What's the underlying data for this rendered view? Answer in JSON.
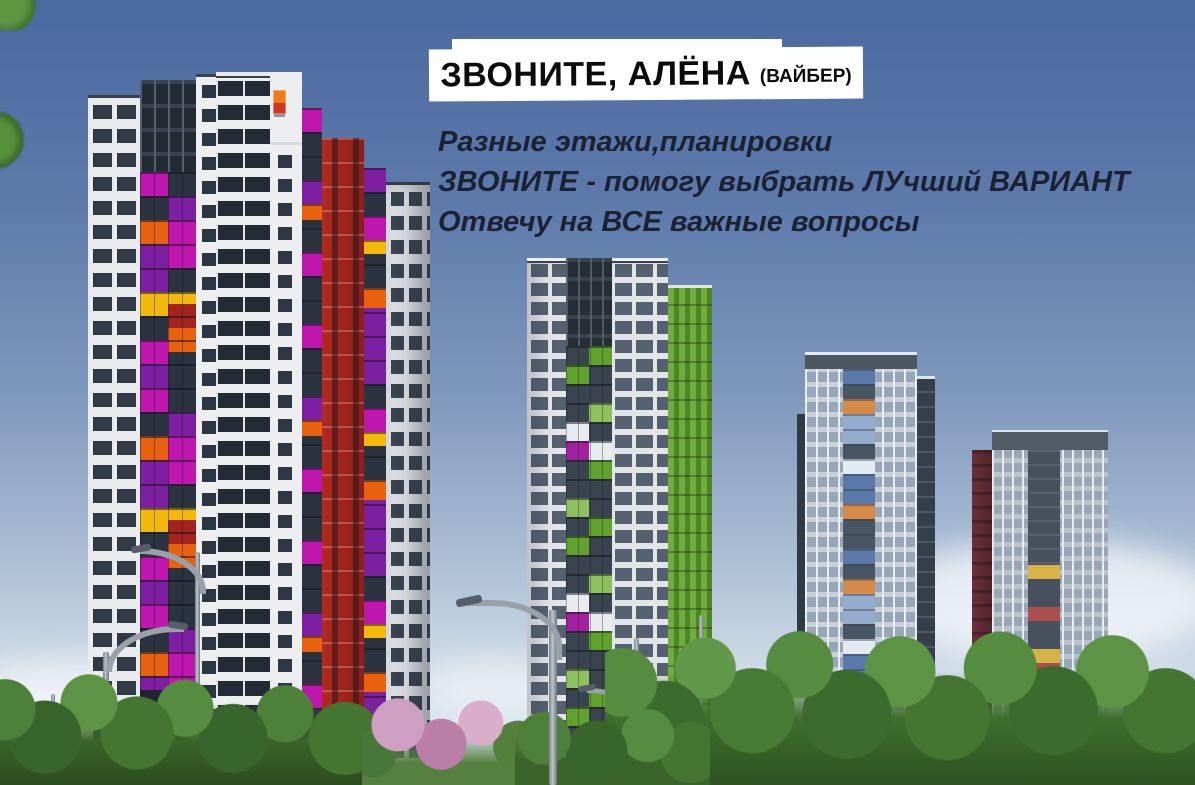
{
  "ad": {
    "headline": "ЗВОНИТЕ, АЛЁНА",
    "headline_note": "(ВАЙБЕР)",
    "lines": [
      "Разные этажи,планировки",
      "ЗВОНИТЕ - помогу выбрать ЛУчший ВАРИАНТ",
      "Отвечу на ВСЕ важные вопросы"
    ],
    "headline_text_color": "#0b0b0b",
    "headline_bg_color": "#ffffff",
    "body_text_color": "#1a2233"
  },
  "scene": {
    "type": "residential-complex-render",
    "sky": {
      "top_color": "#4a699f",
      "horizon_color": "#e4ecf2"
    },
    "towers": [
      {
        "id": "tower-1-left-foreground",
        "facade_color": "#e9ebed",
        "accent_colors": [
          "#bf17ae",
          "#7c1fa0",
          "#e7610f",
          "#f3b90a",
          "#a3241e"
        ]
      },
      {
        "id": "tower-2-center",
        "facade_color": "#e2e5e8",
        "accent_colors": [
          "#61a22e",
          "#8fc05e",
          "#a320a0"
        ]
      },
      {
        "id": "tower-3-center-right",
        "facade_color": "#b6c0c9",
        "accent_colors": [
          "#44659c",
          "#d97a28"
        ]
      },
      {
        "id": "tower-4-right",
        "facade_color": "#aab4bd",
        "accent_colors": [
          "#d9ab25",
          "#a53230",
          "#5c2a32"
        ]
      }
    ],
    "foreground": {
      "tree_color": "#47783a",
      "blossom_color": "#cb96bd",
      "lamp_color": "#98a1a7",
      "storefront_light_color": "#ffba5c"
    }
  }
}
